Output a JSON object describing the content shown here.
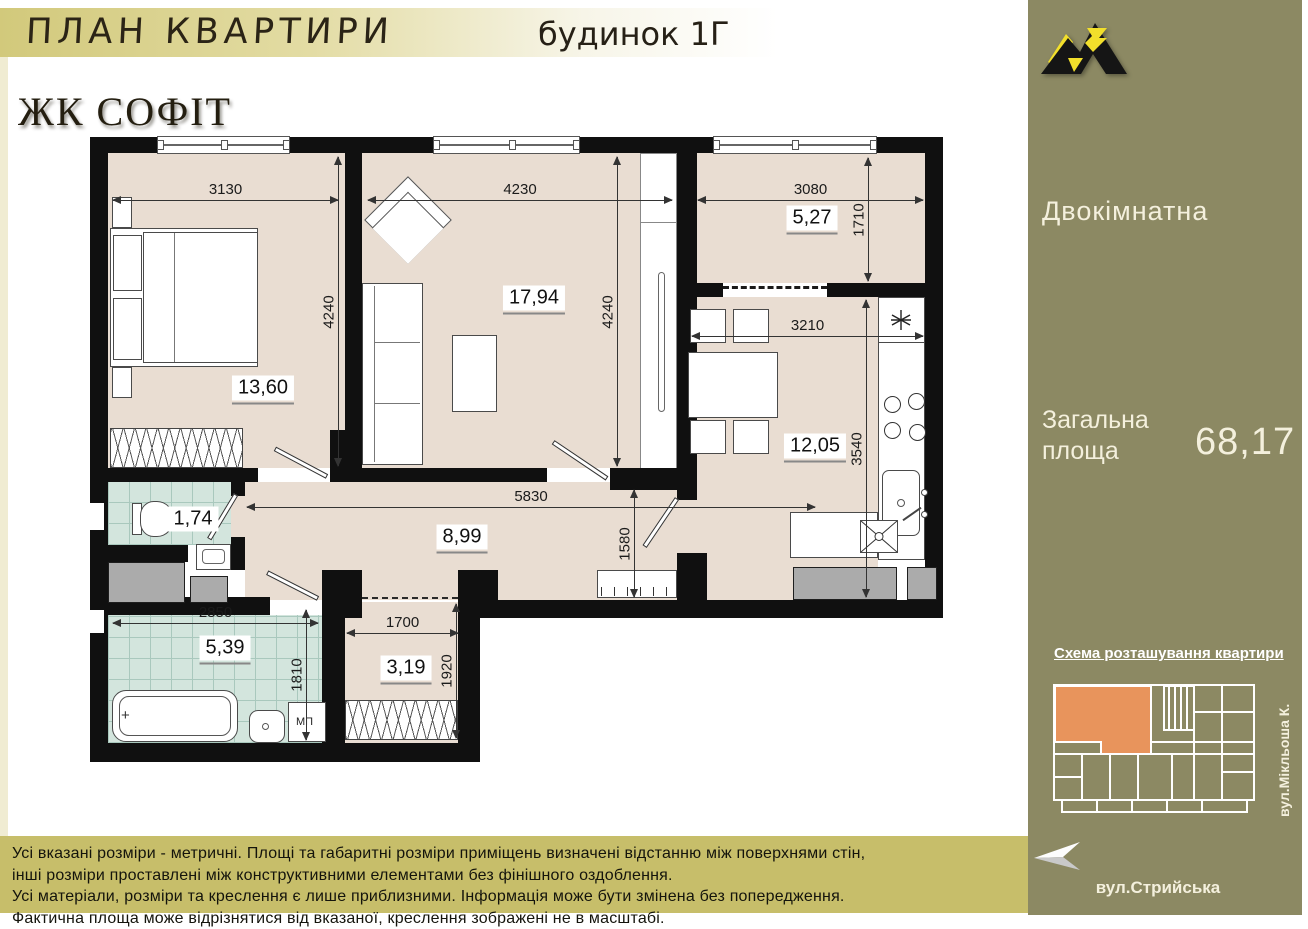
{
  "header": {
    "title": "ПЛАН КВАРТИРИ",
    "building": "будинок 1Г"
  },
  "sidebar": {
    "brand": "ЖК СОФІТ",
    "apartment_type": "Двокімнатна",
    "total_area_label_line1": "Загальна",
    "total_area_label_line2": "площа",
    "total_area_value": "68,17",
    "scheme_title": "Схема розташування квартири",
    "street_side": "вул.Мікльоша К.",
    "street_bottom": "вул.Стрийська"
  },
  "plan": {
    "areas": {
      "bedroom": "13,60",
      "living_room": "17,94",
      "balcony": "5,27",
      "kitchen": "12,05",
      "hall": "8,99",
      "wc": "1,74",
      "bathroom": "5,39",
      "closet": "3,19"
    },
    "dims": {
      "bedroom_w": "3130",
      "living_w": "4230",
      "balcony_w": "3080",
      "bedroom_h": "4240",
      "living_h": "4240",
      "balcony_h": "1710",
      "kitchen_w": "3210",
      "kitchen_h": "3540",
      "hall_w": "5830",
      "entry_h": "1580",
      "bathroom_w": "2850",
      "bathroom_h": "1810",
      "closet_w": "1700",
      "closet_h": "1920"
    },
    "washing_machine_label": "МП"
  },
  "footer": {
    "lines": [
      "Усі вказані розміри - метричні. Площі та габаритні розміри приміщень визначені відстанню між  поверхнями стін,",
      "інші розміри проставлені між конструктивними елементами без фінішного оздоблення.",
      "Усі матеріали, розміри та креслення є лише приблизними. Інформація може бути змінена без попередження.",
      "Фактична площа може відрізнятися від вказаної, креслення зображені не в масштабі."
    ]
  },
  "colors": {
    "sidebar_bg": "#8c8963",
    "footer_bg": "#c7be6a",
    "unit_orange": "#e8945c",
    "logo_yellow": "#f2df2b",
    "floor_beige": "#e9ddd2",
    "tile_teal": "#d3e5dd"
  }
}
